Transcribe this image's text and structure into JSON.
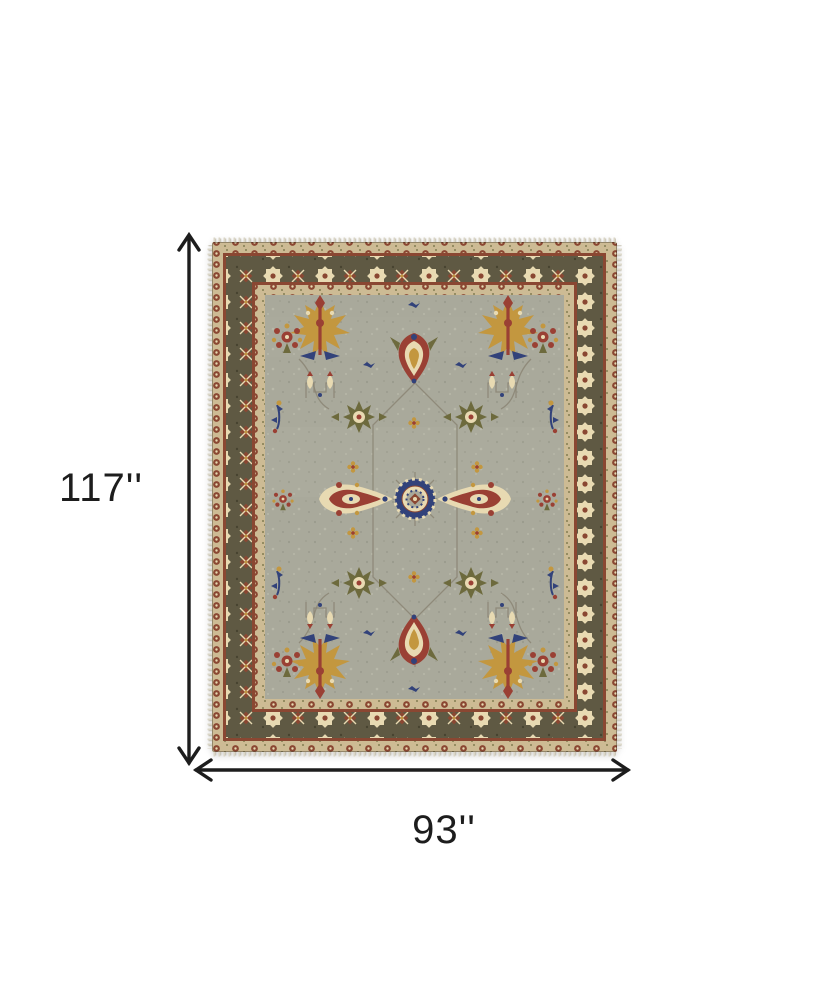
{
  "page": {
    "background": "#ffffff"
  },
  "dimension_annotations": {
    "height": {
      "label": "117''"
    },
    "width": {
      "label": "93''"
    }
  },
  "product_image": {
    "name": "oriental-area-rug-top-view",
    "style": "traditional floral medallion rug with star border"
  },
  "colors": {
    "bg": "#ffffff",
    "ink": "#1d1d1d",
    "field": "#a9a99b",
    "field-light": "#c0bfb0",
    "field-dark": "#8c8d7f",
    "minor-tan": "#cdbb94",
    "border-olive": "#5f5943",
    "border-olive-dark": "#474330",
    "guard-rust": "#8a4732",
    "cream": "#e8dab2",
    "gold": "#c3973f",
    "red": "#9a4034",
    "navy": "#32427a",
    "olive": "#6d6a3d",
    "vine": "#8b8574",
    "fringe": "#dbd6c6"
  }
}
